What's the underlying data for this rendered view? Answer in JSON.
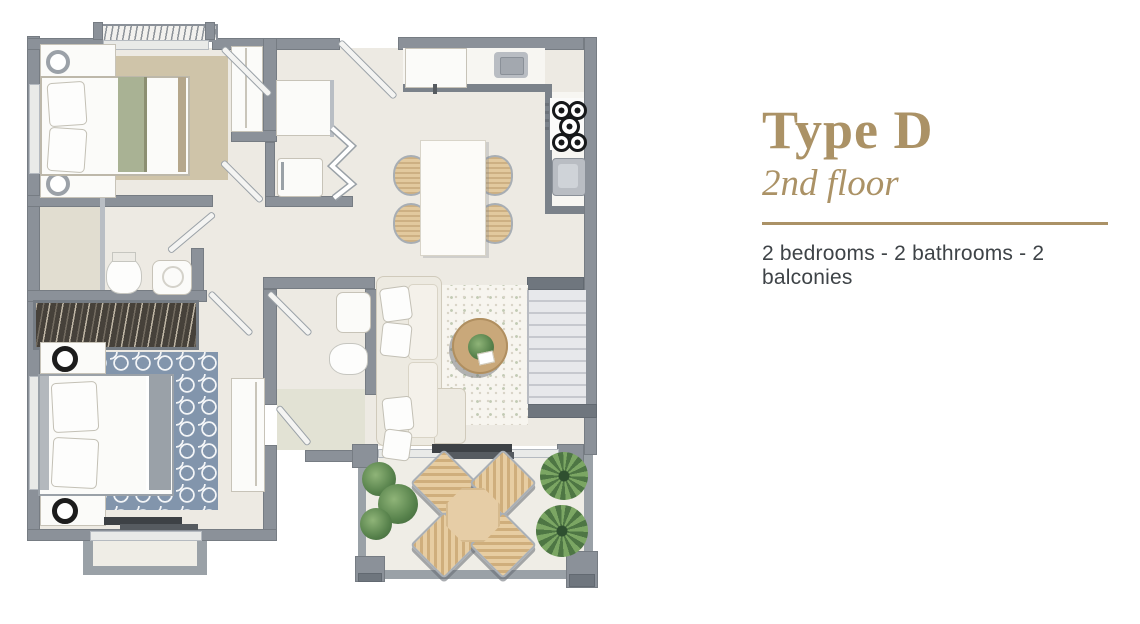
{
  "panel": {
    "title": "Type D",
    "floor_label": "2nd floor",
    "features": "2 bedrooms - 2 bathrooms - 2 balconies"
  },
  "colors": {
    "accent": "#ab9266",
    "featuretext": "#3e4347",
    "wall": "#8b9199",
    "floor": "#edeae3"
  },
  "plan": {
    "rooms": [
      "bedroom-1",
      "bedroom-2",
      "bathroom-1",
      "bathroom-2",
      "kitchen",
      "dining-area",
      "living-room",
      "hallway",
      "stairs",
      "main-balcony",
      "bedroom-balcony"
    ]
  }
}
